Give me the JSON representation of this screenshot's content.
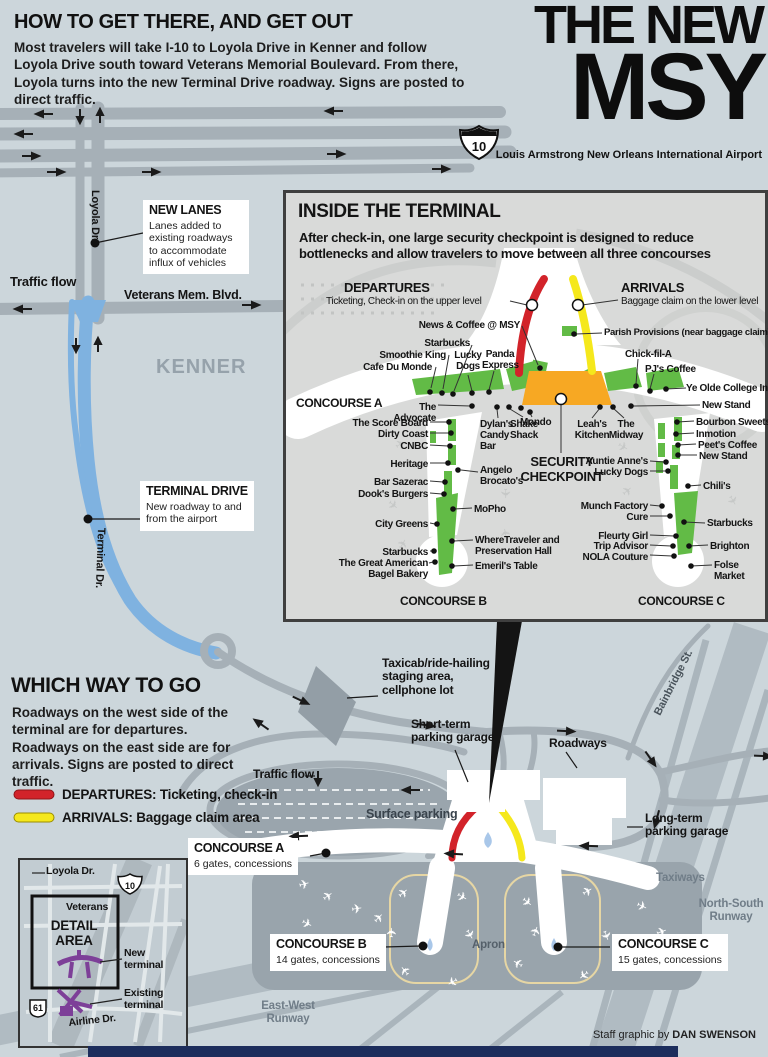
{
  "header": {
    "title": "HOW TO GET THERE, AND GET OUT",
    "intro": "Most travelers will take I-10 to Loyola Drive in Kenner and follow Loyola Drive south toward Veterans Memorial Boulevard. From there, Loyola turns into the new Terminal Drive roadway. Signs are posted to direct traffic."
  },
  "masthead": {
    "line1": "THE NEW",
    "line2": "MSY",
    "subtitle": "Louis Armstrong New Orleans International Airport"
  },
  "upper_map": {
    "i10": "10",
    "loyola": "Loyola Dr.",
    "traffic_flow": "Traffic flow",
    "veterans": "Veterans Mem. Blvd.",
    "kenner": "KENNER",
    "terminal_dr": "Terminal Dr.",
    "new_lanes": {
      "title": "NEW LANES",
      "body": "Lanes added to existing roadways to accommodate influx of vehicles"
    },
    "terminal_drive": {
      "title": "TERMINAL DRIVE",
      "body": "New roadway to and from the airport"
    }
  },
  "inset": {
    "title": "INSIDE THE TERMINAL",
    "subtitle": "After check-in, one large security checkpoint is designed to reduce bottlenecks and allow travelers to move between all three concourses",
    "departures": {
      "title": "DEPARTURES",
      "sub": "Ticketing, Check-in on the upper level"
    },
    "arrivals": {
      "title": "ARRIVALS",
      "sub": "Baggage claim on the lower level"
    },
    "security": "SECURITY CHECKPOINT",
    "concourse_a": "CONCOURSE A",
    "concourse_b": "CONCOURSE B",
    "concourse_c": "CONCOURSE C",
    "shops": {
      "news_coffee": "News & Coffee @ MSY",
      "starbucks_a": "Starbucks",
      "smoothie_king": "Smoothie King",
      "cafe_du_monde": "Cafe Du Monde",
      "lucky_dogs_a": "Lucky Dogs",
      "panda_express": "Panda Express",
      "advocate": "The Advocate",
      "score_board": "The Score Board",
      "dirty_coast": "Dirty Coast",
      "cnbc": "CNBC",
      "heritage": "Heritage",
      "bar_sazerac": "Bar Sazerac",
      "dooks": "Dook's Burgers",
      "city_greens": "City Greens",
      "starbucks_b": "Starbucks",
      "bagel_bakery": "The Great American Bagel Bakery",
      "dylans": "Dylan's Candy Bar",
      "shake_shack": "Shake Shack",
      "mondo": "Mondo",
      "angelo": "Angelo Brocato's",
      "mopho": "MoPho",
      "wheretraveler": "WhereTraveler and Preservation Hall",
      "emerils": "Emeril's Table",
      "leahs": "Leah's Kitchen",
      "midway": "The Midway",
      "auntie_annes": "Auntie Anne's",
      "lucky_dogs_c": "Lucky Dogs",
      "munch_factory": "Munch Factory",
      "cure": "Cure",
      "fleurty_girl": "Fleurty Girl",
      "trip_advisor": "Trip Advisor",
      "nola_couture": "NOLA Couture",
      "parish": "Parish Provisions (near baggage claim)",
      "chick_fil_a": "Chick-fil-A",
      "pjs": "PJ's Coffee",
      "ye_olde": "Ye Olde College Inn",
      "new_stand_1": "New Stand",
      "bourbon_sweets": "Bourbon Sweets",
      "inmotion": "Inmotion",
      "peets": "Peet's Coffee",
      "new_stand_2": "New Stand",
      "chilis": "Chili's",
      "starbucks_c": "Starbucks",
      "brighton": "Brighton",
      "folse": "Folse Market"
    }
  },
  "which_way": {
    "title": "WHICH WAY TO GO",
    "body": "Roadways on the west side of the terminal are for departures. Roadways on the east side are for arrivals. Signs are posted to direct traffic.",
    "legend": [
      {
        "label": "DEPARTURES: Ticketing, check-in"
      },
      {
        "label": "ARRIVALS: Baggage claim area"
      }
    ]
  },
  "lower_map": {
    "taxicab": "Taxicab/ride-hailing staging area, cellphone lot",
    "short_term": "Short-term parking garage",
    "roadways": "Roadways",
    "traffic_flow": "Traffic flow",
    "surface_parking": "Surface parking",
    "long_term": "Long-term parking garage",
    "bainbridge": "Bainbridge St.",
    "taxiways": "Taxiways",
    "ns_runway": "North-South Runway",
    "ew_runway": "East-West Runway",
    "apron": "Apron",
    "concourses": [
      {
        "name": "CONCOURSE A",
        "sub": "6 gates, concessions"
      },
      {
        "name": "CONCOURSE B",
        "sub": "14 gates, concessions"
      },
      {
        "name": "CONCOURSE C",
        "sub": "15 gates, concessions"
      }
    ]
  },
  "detail": {
    "loyola": "Loyola Dr.",
    "i10": "10",
    "veterans": "Veterans",
    "area": "DETAIL AREA",
    "new_terminal": "New terminal",
    "existing_terminal": "Existing terminal",
    "us61": "61",
    "airline": "Airline Dr."
  },
  "credit": {
    "prefix": "Staff graphic by ",
    "name": "DAN SWENSON"
  },
  "colors": {
    "departures_red": "#d2232a",
    "arrivals_yellow": "#f5e81c",
    "checkpoint_orange": "#f7a823",
    "concession_green": "#62bb46",
    "road_blue": "#7fb2e0",
    "terminal_purple": "#7d3f98"
  }
}
